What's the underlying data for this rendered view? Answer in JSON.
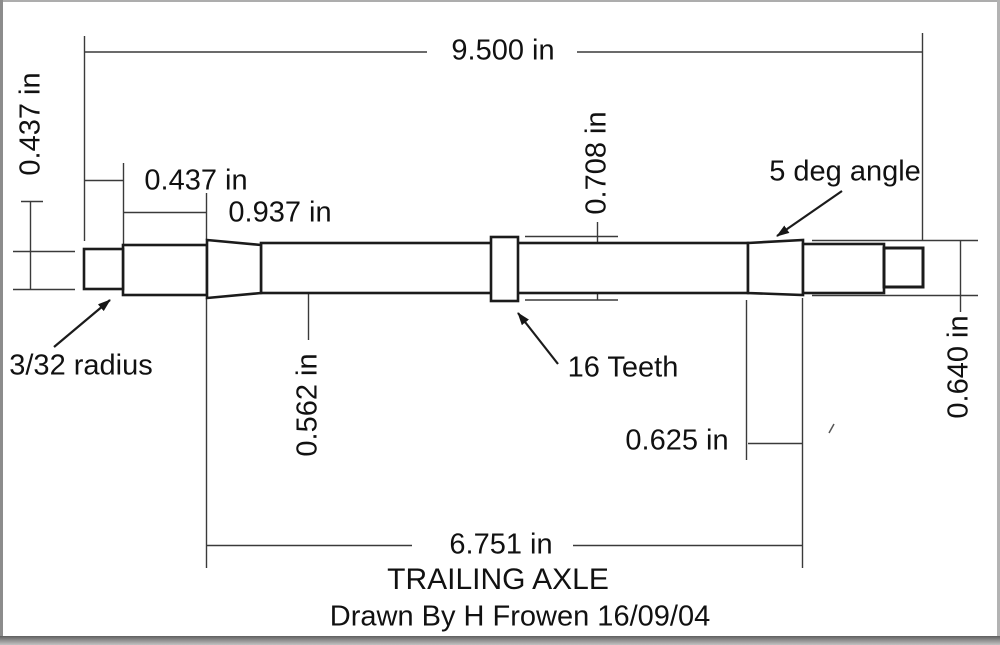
{
  "drawing": {
    "title": "TRAILING AXLE",
    "credit": "Drawn By H Frowen 16/09/04",
    "dims": {
      "overall_length": "9.500 in",
      "left_stub_diameter": "0.437 in",
      "left_stub_length": "0.437 in",
      "left_journal_length": "0.937 in",
      "shaft_diameter": "0.562 in",
      "gear_diameter": "0.708 in",
      "taper_length": "0.625 in",
      "taper_diameter": "0.640 in",
      "between_tapers": "6.751 in"
    },
    "notes": {
      "radius": "3/32 radius",
      "angle": "5 deg angle",
      "teeth": "16 Teeth"
    },
    "colors": {
      "outline": "#1b1b1b",
      "dimension_line": "#3a3a3a",
      "text": "#111111",
      "background": "#ffffff",
      "frame": "#8f8f8f"
    }
  }
}
